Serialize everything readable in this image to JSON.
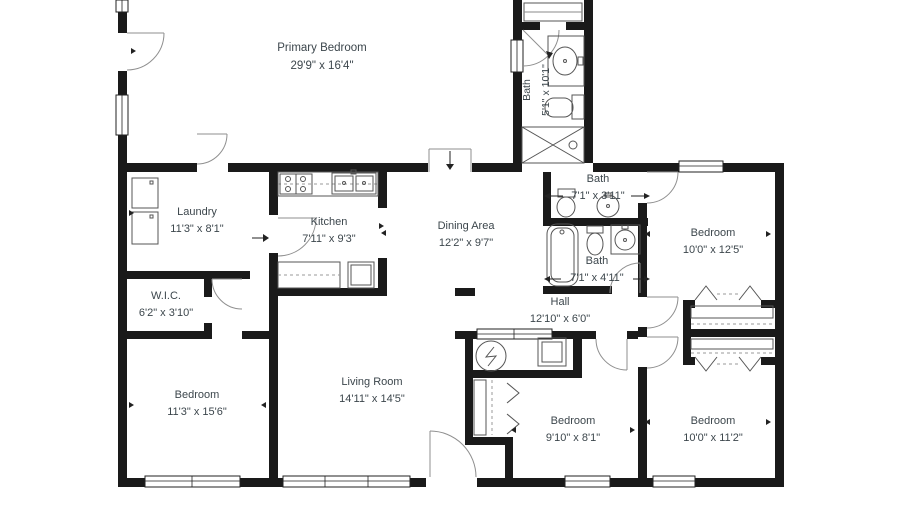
{
  "floorplan": {
    "title": "Single-story house floor plan",
    "rooms": [
      {
        "name": "Primary Bedroom",
        "dims": "29'9\" x 16'4\""
      },
      {
        "name": "Bath",
        "dims": "5'1\" x 10'1\""
      },
      {
        "name": "Laundry",
        "dims": "11'3\" x 8'1\""
      },
      {
        "name": "Kitchen",
        "dims": "7'11\" x 9'3\""
      },
      {
        "name": "Dining Area",
        "dims": "12'2\" x 9'7\""
      },
      {
        "name": "Bath",
        "dims": "7'1\" x 3'11\""
      },
      {
        "name": "Bedroom",
        "dims": "10'0\" x 12'5\""
      },
      {
        "name": "Bath",
        "dims": "7'1\" x 4'11\""
      },
      {
        "name": "W.I.C.",
        "dims": "6'2\" x 3'10\""
      },
      {
        "name": "Hall",
        "dims": "12'10\" x 6'0\""
      },
      {
        "name": "Bedroom",
        "dims": "11'3\" x 15'6\""
      },
      {
        "name": "Living Room",
        "dims": "14'11\" x 14'5\""
      },
      {
        "name": "Bedroom",
        "dims": "9'10\" x 8'1\""
      },
      {
        "name": "Bedroom",
        "dims": "10'0\" x 11'2\""
      }
    ],
    "colors": {
      "wall": "#1a1a1a",
      "text": "#3c464c",
      "fixture": "#555555"
    }
  }
}
